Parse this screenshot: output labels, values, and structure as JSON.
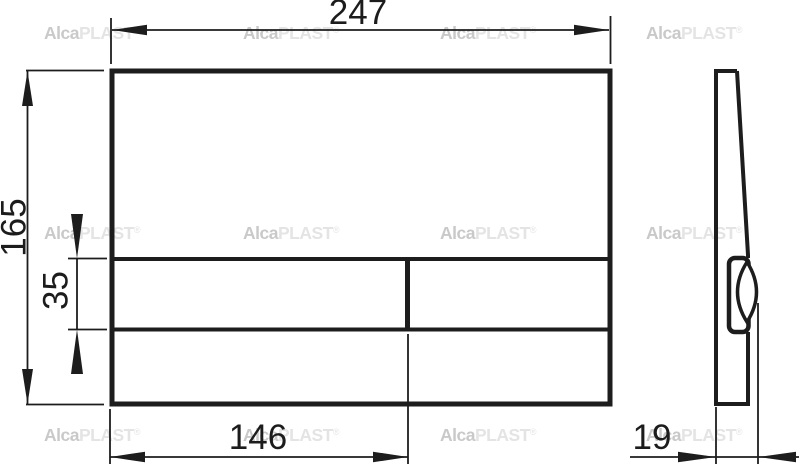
{
  "watermark": {
    "brand_bold": "Alca",
    "brand_light": "PLAST",
    "registered": "®"
  },
  "dimensions": {
    "plate_width": "247",
    "plate_height": "165",
    "button_row_height": "35",
    "large_button_width": "146",
    "plate_depth": "19"
  },
  "colors": {
    "line": "#1d1d1d",
    "background": "#ffffff",
    "watermark_bold": "#c9c9c9",
    "watermark_light": "#e4e4e4"
  }
}
